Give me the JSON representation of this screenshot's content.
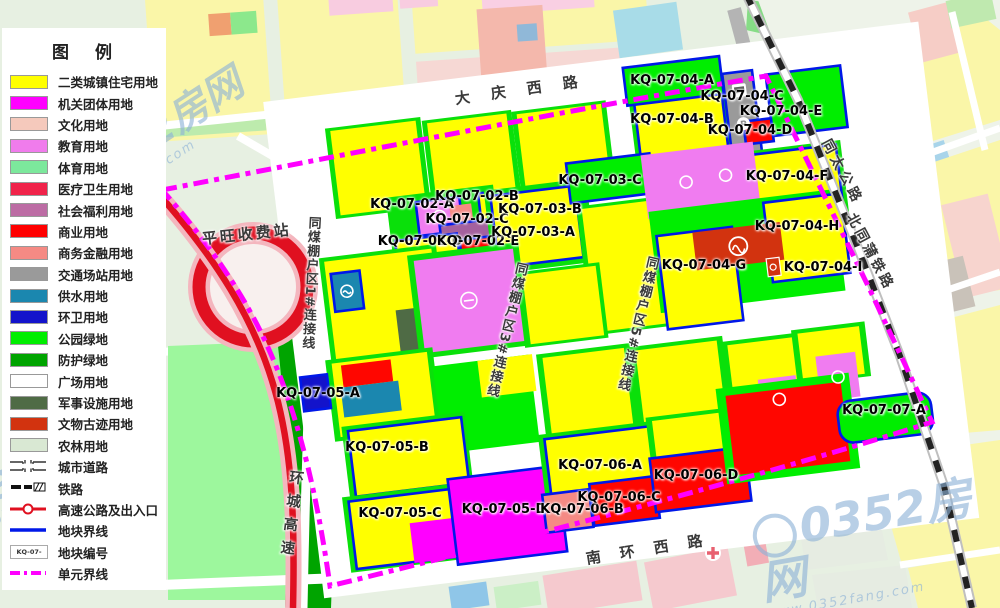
{
  "legend": {
    "title": "图  例",
    "items": [
      {
        "label": "二类城镇住宅用地",
        "type": "swatch",
        "color": "#FFFF00"
      },
      {
        "label": "机关团体用地",
        "type": "swatch",
        "color": "#FF00FF"
      },
      {
        "label": "文化用地",
        "type": "swatch",
        "color": "#F5C9BC"
      },
      {
        "label": "教育用地",
        "type": "swatch",
        "color": "#F07CEC"
      },
      {
        "label": "体育用地",
        "type": "swatch",
        "color": "#7CE89C"
      },
      {
        "label": "医疗卫生用地",
        "type": "swatch",
        "color": "#F0234A"
      },
      {
        "label": "社会福利用地",
        "type": "swatch",
        "color": "#BC6CA4"
      },
      {
        "label": "商业用地",
        "type": "swatch",
        "color": "#FF0000"
      },
      {
        "label": "商务金融用地",
        "type": "swatch",
        "color": "#F58A84"
      },
      {
        "label": "交通场站用地",
        "type": "swatch",
        "color": "#9A9A9A"
      },
      {
        "label": "供水用地",
        "type": "swatch",
        "color": "#1B87AF"
      },
      {
        "label": "环卫用地",
        "type": "swatch",
        "color": "#1313CB"
      },
      {
        "label": "公园绿地",
        "type": "swatch",
        "color": "#00EE00"
      },
      {
        "label": "防护绿地",
        "type": "swatch",
        "color": "#00A400"
      },
      {
        "label": "广场用地",
        "type": "swatch",
        "color": "#FFFFFF"
      },
      {
        "label": "军事设施用地",
        "type": "swatch",
        "color": "#4F6B45"
      },
      {
        "label": "文物古迹用地",
        "type": "swatch",
        "color": "#D2330F"
      },
      {
        "label": "农林用地",
        "type": "swatch",
        "color": "#D9E8D3"
      },
      {
        "label": "城市道路",
        "type": "road"
      },
      {
        "label": "铁路",
        "type": "railway"
      },
      {
        "label": "高速公路及出入口",
        "type": "highway"
      },
      {
        "label": "地块界线",
        "type": "parcel-line"
      },
      {
        "label": "地块编号",
        "type": "parcel-code",
        "sample": "KQ-07-03-A"
      },
      {
        "label": "单元界线",
        "type": "unit-line"
      }
    ]
  },
  "map": {
    "road_labels": [
      {
        "text": "大 庆 西 路",
        "x": 455,
        "y": 88,
        "rot": -8,
        "size": 15,
        "spacing": 8
      },
      {
        "text": "南 环 西 路",
        "x": 586,
        "y": 548,
        "rot": -9,
        "size": 15,
        "spacing": 7
      },
      {
        "text": "同太公路",
        "x": 826,
        "y": 130,
        "rot": 62,
        "size": 14,
        "spacing": 4
      },
      {
        "text": "北同蒲铁路",
        "x": 851,
        "y": 204,
        "rot": 62,
        "size": 14,
        "spacing": 3
      },
      {
        "text": "平旺收费站",
        "x": 202,
        "y": 228,
        "rot": -6,
        "size": 15,
        "spacing": 3
      },
      {
        "text": "环城高速",
        "x": 286,
        "y": 470,
        "rot": 7,
        "size": 14.5,
        "spacing": 9,
        "vertical": true
      },
      {
        "text": "同煤棚户区1#连接线",
        "x": 304,
        "y": 216,
        "rot": 3,
        "size": 13,
        "spacing": 1,
        "vertical": true
      },
      {
        "text": "同煤棚户区3#连接线",
        "x": 512,
        "y": 262,
        "rot": 13,
        "size": 13,
        "spacing": 1.5,
        "vertical": true
      },
      {
        "text": "同煤棚户区5#连接线",
        "x": 643,
        "y": 256,
        "rot": 13,
        "size": 13,
        "spacing": 1.5,
        "vertical": true
      }
    ],
    "parcel_labels": [
      {
        "text": "KQ-07-02-A",
        "x": 412,
        "y": 205
      },
      {
        "text": "KQ-07-02-B",
        "x": 477,
        "y": 197
      },
      {
        "text": "KQ-07-02-C",
        "x": 467,
        "y": 220
      },
      {
        "text": "KQ-07-02-D",
        "x": 420,
        "y": 242
      },
      {
        "text": "KQ-07-02-E",
        "x": 478,
        "y": 242
      },
      {
        "text": "KQ-07-03-A",
        "x": 533,
        "y": 233
      },
      {
        "text": "KQ-07-03-B",
        "x": 540,
        "y": 210
      },
      {
        "text": "KQ-07-03-C",
        "x": 600,
        "y": 181
      },
      {
        "text": "KQ-07-04-A",
        "x": 672,
        "y": 81
      },
      {
        "text": "KQ-07-04-B",
        "x": 672,
        "y": 120
      },
      {
        "text": "KQ-07-04-C",
        "x": 742,
        "y": 97
      },
      {
        "text": "KQ-07-04-D",
        "x": 750,
        "y": 131
      },
      {
        "text": "KQ-07-04-E",
        "x": 781,
        "y": 112
      },
      {
        "text": "KQ-07-04-F",
        "x": 787,
        "y": 177
      },
      {
        "text": "KQ-07-04-G",
        "x": 704,
        "y": 266
      },
      {
        "text": "KQ-07-04-H",
        "x": 797,
        "y": 227
      },
      {
        "text": "KQ-07-04-I",
        "x": 823,
        "y": 268
      },
      {
        "text": "KQ-07-05-A",
        "x": 318,
        "y": 394
      },
      {
        "text": "KQ-07-05-B",
        "x": 387,
        "y": 448
      },
      {
        "text": "KQ-07-05-C",
        "x": 400,
        "y": 514
      },
      {
        "text": "KQ-07-05-D",
        "x": 504,
        "y": 510
      },
      {
        "text": "KQ-07-06-A",
        "x": 600,
        "y": 466
      },
      {
        "text": "KQ-07-06-B",
        "x": 582,
        "y": 510
      },
      {
        "text": "KQ-07-06-C",
        "x": 619,
        "y": 498
      },
      {
        "text": "KQ-07-06-D",
        "x": 696,
        "y": 476
      },
      {
        "text": "KQ-07-07-A",
        "x": 884,
        "y": 411
      }
    ],
    "watermarks": [
      {
        "text": "0352房网",
        "sub": "www.0352fang.com",
        "x": 48,
        "y": 185,
        "rot": -33,
        "size": 40,
        "ring": 30
      },
      {
        "text": "0352房网",
        "sub": "www.0352fang.com",
        "x": 758,
        "y": 512,
        "rot": -10,
        "size": 46,
        "ring": 36
      },
      {
        "text": "0352房网",
        "sub": "www.0352fang.com",
        "x": -52,
        "y": 505,
        "rot": -33,
        "size": 34,
        "ring": 24
      }
    ]
  }
}
